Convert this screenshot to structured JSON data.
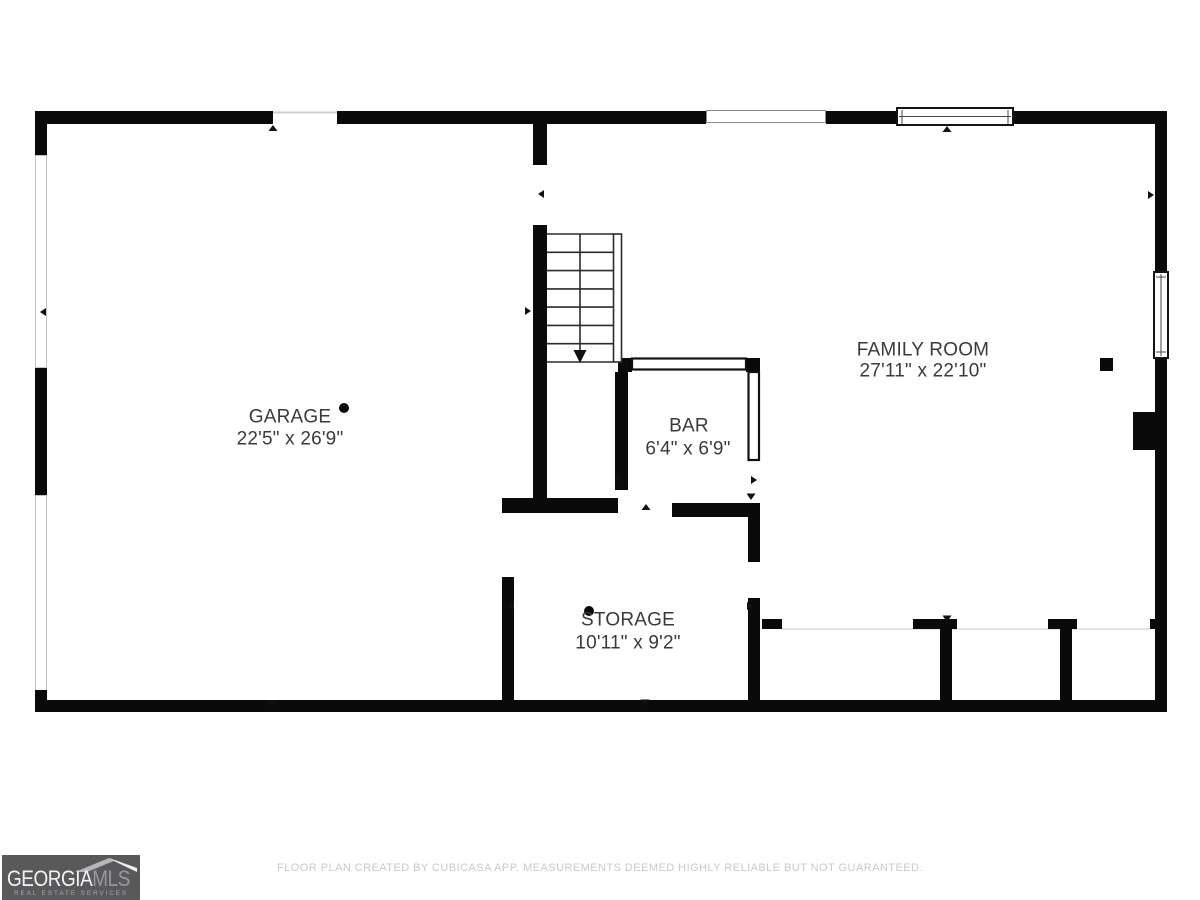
{
  "floorplan": {
    "rooms": [
      {
        "name": "GARAGE",
        "dims": "22'5\" x 26'9\""
      },
      {
        "name": "FAMILY ROOM",
        "dims": "27'11\" x 22'10\""
      },
      {
        "name": "BAR",
        "dims": "6'4\" x 6'9\""
      },
      {
        "name": "STORAGE",
        "dims": "10'11\" x 9'2\""
      }
    ]
  },
  "footer": {
    "disclaimer": "FLOOR PLAN CREATED BY CUBICASA APP. MEASUREMENTS DEEMED HIGHLY RELIABLE BUT NOT GUARANTEED."
  },
  "logo": {
    "brand_primary": "GEORGIA",
    "brand_secondary": "MLS",
    "tagline": "REAL ESTATE SERVICES"
  },
  "colors": {
    "wall": "#0a0a0a",
    "label_text": "#3a3a3a",
    "logo_background": "#59595b",
    "footer_text": "#c9c9c9"
  }
}
